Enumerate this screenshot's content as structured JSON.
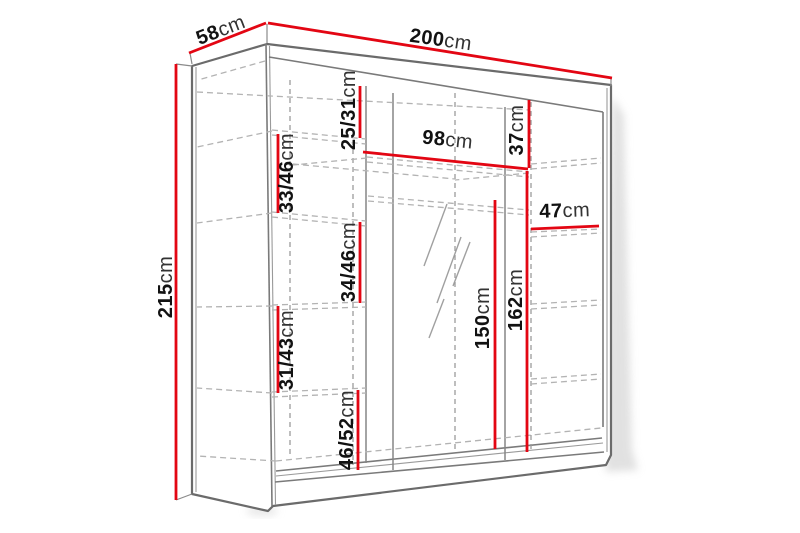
{
  "diagram": {
    "subject": "wardrobe-dimension-drawing",
    "unit": "cm",
    "colors": {
      "dimension_line": "#e30613",
      "outline": "#6b6b6b",
      "hidden_line": "#b3b3b3",
      "label_text": "#121212",
      "background": "#ffffff"
    }
  },
  "dimensions": {
    "depth": {
      "value": "58",
      "unit": "cm"
    },
    "width": {
      "value": "200",
      "unit": "cm"
    },
    "height": {
      "value": "215",
      "unit": "cm"
    },
    "left_shelf_1": {
      "value": "25/31",
      "unit": "cm"
    },
    "left_shelf_2": {
      "value": "33/46",
      "unit": "cm"
    },
    "left_shelf_3": {
      "value": "34/46",
      "unit": "cm"
    },
    "left_shelf_4": {
      "value": "31/43",
      "unit": "cm"
    },
    "left_shelf_5": {
      "value": "46/52",
      "unit": "cm"
    },
    "middle_width": {
      "value": "98",
      "unit": "cm"
    },
    "right_top": {
      "value": "37",
      "unit": "cm"
    },
    "right_width": {
      "value": "47",
      "unit": "cm"
    },
    "hanging_space": {
      "value": "150",
      "unit": "cm"
    },
    "right_interior": {
      "value": "162",
      "unit": "cm"
    }
  }
}
